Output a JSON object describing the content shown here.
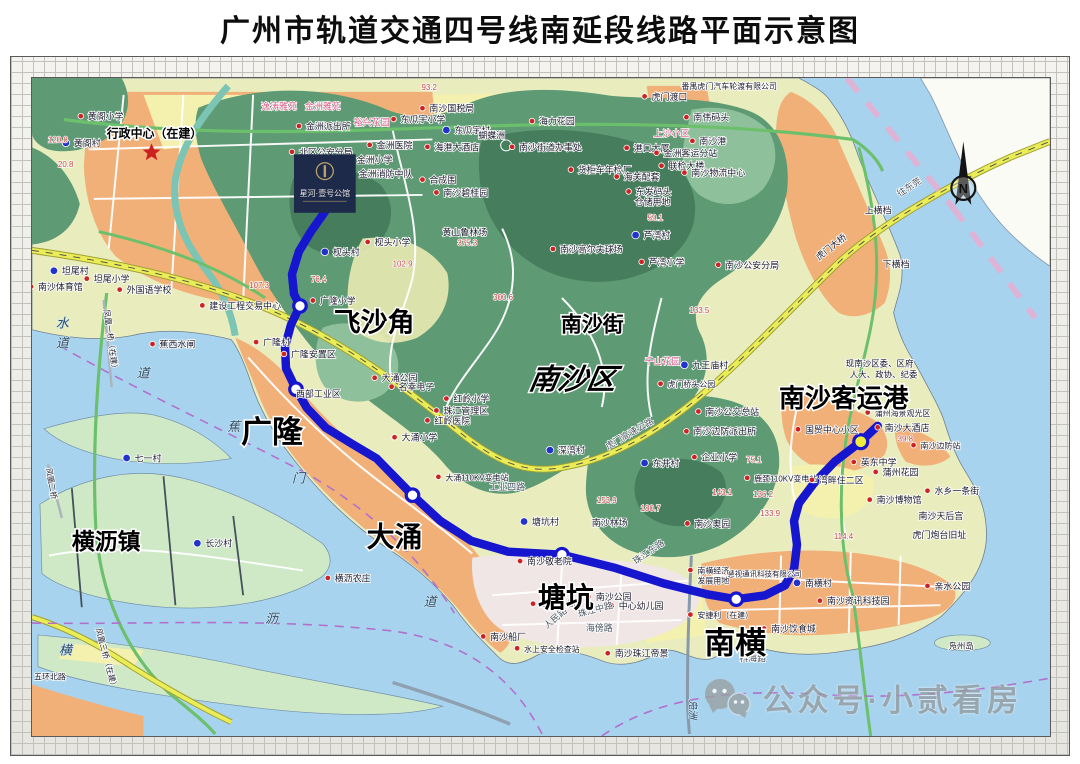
{
  "title": "广州市轨道交通四号线南延段线路平面示意图",
  "watermark": {
    "text": "公众号·小贰看房",
    "icon": "wechat-icon"
  },
  "compass": {
    "label": "N"
  },
  "ad_overlay": {
    "title": "星河·壹号公馆"
  },
  "palette": {
    "metro_line": "#1616cf",
    "station_fill": "#ffffff",
    "terminal_fill": "#f0ec3e",
    "red_dot": "#cc2424",
    "blue_dot": "#2233cc",
    "spot_text": "#c04848",
    "star": "#cc1f1f"
  },
  "map": {
    "line": {
      "name": "四号线南延段",
      "color": "#1616cf",
      "points": [
        [
          322,
          213
        ],
        [
          308,
          233
        ],
        [
          296,
          253
        ],
        [
          289,
          276
        ],
        [
          291,
          296
        ],
        [
          297,
          308
        ],
        [
          288,
          327
        ],
        [
          282,
          349
        ],
        [
          283,
          371
        ],
        [
          293,
          392
        ],
        [
          304,
          411
        ],
        [
          323,
          431
        ],
        [
          349,
          447
        ],
        [
          374,
          462
        ],
        [
          410,
          499
        ],
        [
          438,
          525
        ],
        [
          469,
          545
        ],
        [
          506,
          556
        ],
        [
          560,
          559
        ],
        [
          612,
          572
        ],
        [
          662,
          588
        ],
        [
          706,
          599
        ],
        [
          735,
          604
        ],
        [
          764,
          600
        ],
        [
          784,
          590
        ],
        [
          793,
          574
        ],
        [
          796,
          549
        ],
        [
          793,
          525
        ],
        [
          798,
          507
        ],
        [
          813,
          487
        ],
        [
          834,
          465
        ],
        [
          860,
          445
        ],
        [
          877,
          429
        ]
      ]
    },
    "stations": [
      {
        "name": "飞沙角",
        "x": 297,
        "y": 308,
        "lx": 331,
        "ly": 334,
        "fs": 27
      },
      {
        "name": "广隆",
        "x": 293,
        "y": 392,
        "lx": 238,
        "ly": 446,
        "fs": 31
      },
      {
        "name": "大涌",
        "x": 410,
        "y": 499,
        "lx": 364,
        "ly": 551,
        "fs": 28
      },
      {
        "name": "塘坑",
        "x": 560,
        "y": 559,
        "lx": 536,
        "ly": 612,
        "fs": 28
      },
      {
        "name": "南横",
        "x": 735,
        "y": 604,
        "lx": 703,
        "ly": 659,
        "fs": 31
      },
      {
        "name": "南沙客运港",
        "x": 860,
        "y": 445,
        "lx": 778,
        "ly": 410,
        "fs": 26,
        "terminal": true
      }
    ],
    "area_labels": [
      {
        "t": "行政中心（在建）",
        "x": 103,
        "y": 138,
        "fs": 12
      },
      {
        "t": "南沙街",
        "x": 559,
        "y": 334,
        "fs": 21
      },
      {
        "t": "南沙区",
        "x": 526,
        "y": 392,
        "fs": 29,
        "italic": true
      },
      {
        "t": "横沥镇",
        "x": 68,
        "y": 554,
        "fs": 23
      }
    ],
    "pois": [
      {
        "t": "黄阁小学",
        "x": 84,
        "y": 120,
        "k": "r"
      },
      {
        "t": "黄阁村",
        "x": 70,
        "y": 147,
        "k": "b"
      },
      {
        "t": "120.8",
        "x": 44,
        "y": 143,
        "k": "s"
      },
      {
        "t": "20.8",
        "x": 54,
        "y": 168,
        "k": "s"
      },
      {
        "t": "93.2",
        "x": 419,
        "y": 90,
        "k": "s"
      },
      {
        "t": "南沙国税局",
        "x": 427,
        "y": 112,
        "k": "r"
      },
      {
        "t": "东瓜宇小学",
        "x": 398,
        "y": 123,
        "k": "r"
      },
      {
        "t": "东瓜宇村",
        "x": 452,
        "y": 134,
        "k": "b"
      },
      {
        "t": "海港大酒店",
        "x": 432,
        "y": 151,
        "k": "r"
      },
      {
        "t": "蝴蝶洲",
        "x": 476,
        "y": 139,
        "k": "n"
      },
      {
        "t": "海力花园",
        "x": 537,
        "y": 125,
        "k": "r"
      },
      {
        "t": "南沙街道办事处",
        "x": 517,
        "y": 151,
        "k": "r"
      },
      {
        "t": "货柜车年检厂",
        "x": 576,
        "y": 174,
        "k": "r"
      },
      {
        "t": "港口大厦",
        "x": 632,
        "y": 152,
        "k": "r"
      },
      {
        "t": "海关配套",
        "x": 622,
        "y": 181,
        "k": "r"
      },
      {
        "t": "金洲客运分站",
        "x": 662,
        "y": 157,
        "k": "r"
      },
      {
        "t": "联检大楼",
        "x": 667,
        "y": 170,
        "k": "r"
      },
      {
        "t": "南沙物流中心",
        "x": 690,
        "y": 177,
        "k": "r"
      },
      {
        "t": "东发码头",
        "x": 634,
        "y": 196,
        "k": "r"
      },
      {
        "t": "仓储用地",
        "x": 633,
        "y": 206,
        "k": "n"
      },
      {
        "t": "虎门渡口",
        "x": 650,
        "y": 100,
        "k": "r"
      },
      {
        "t": "番禺虎门汽车轮渡有限公司",
        "x": 680,
        "y": 89,
        "k": "n",
        "fs": 8
      },
      {
        "t": "上沙小区",
        "x": 652,
        "y": 137,
        "k": "p"
      },
      {
        "t": "南伟码头",
        "x": 692,
        "y": 121,
        "k": "r"
      },
      {
        "t": "南沙港",
        "x": 698,
        "y": 145,
        "k": "r"
      },
      {
        "t": "逸涛雅苑",
        "x": 258,
        "y": 110,
        "k": "p"
      },
      {
        "t": "金洲雅苑",
        "x": 302,
        "y": 110,
        "k": "p"
      },
      {
        "t": "裕兴花园",
        "x": 351,
        "y": 126,
        "k": "p"
      },
      {
        "t": "金洲派出所",
        "x": 303,
        "y": 130,
        "k": "r"
      },
      {
        "t": "金洲医院",
        "x": 374,
        "y": 149,
        "k": "r"
      },
      {
        "t": "金洲小学",
        "x": 354,
        "y": 164,
        "k": "r"
      },
      {
        "t": "金洲消防中队",
        "x": 356,
        "y": 178,
        "k": "r"
      },
      {
        "t": "北区公安分局",
        "x": 296,
        "y": 156,
        "k": "r"
      },
      {
        "t": "合成围",
        "x": 427,
        "y": 184,
        "k": "r"
      },
      {
        "t": "南沙碧桂园",
        "x": 441,
        "y": 197,
        "k": "r"
      },
      {
        "t": "枧头村",
        "x": 330,
        "y": 257,
        "k": "b"
      },
      {
        "t": "枧头小学",
        "x": 372,
        "y": 247,
        "k": "r"
      },
      {
        "t": "76.4",
        "x": 308,
        "y": 284,
        "k": "s"
      },
      {
        "t": "107.3",
        "x": 246,
        "y": 290,
        "k": "s"
      },
      {
        "t": "102.9",
        "x": 390,
        "y": 268,
        "k": "s"
      },
      {
        "t": "广隆小学",
        "x": 317,
        "y": 306,
        "k": "r"
      },
      {
        "t": "黄山鲁林场",
        "x": 440,
        "y": 237,
        "k": "n"
      },
      {
        "t": "375.3",
        "x": 455,
        "y": 247,
        "k": "s"
      },
      {
        "t": "300.6",
        "x": 491,
        "y": 302,
        "k": "s"
      },
      {
        "t": "南沙高尔夫球场",
        "x": 558,
        "y": 254,
        "k": "r"
      },
      {
        "t": "芦湾村",
        "x": 642,
        "y": 240,
        "k": "b"
      },
      {
        "t": "芦湾小学",
        "x": 647,
        "y": 267,
        "k": "r"
      },
      {
        "t": "南沙公安分局",
        "x": 724,
        "y": 270,
        "k": "r"
      },
      {
        "t": "59.1",
        "x": 646,
        "y": 222,
        "k": "s"
      },
      {
        "t": "133.5",
        "x": 688,
        "y": 315,
        "k": "s"
      },
      {
        "t": "千山花园",
        "x": 643,
        "y": 367,
        "k": "p"
      },
      {
        "t": "九王庙村",
        "x": 691,
        "y": 371,
        "k": "b"
      },
      {
        "t": "虎门桥头公园",
        "x": 666,
        "y": 390,
        "k": "r",
        "fs": 8
      },
      {
        "t": "南沙公交总站",
        "x": 704,
        "y": 418,
        "k": "r"
      },
      {
        "t": "南沙边防派出所",
        "x": 692,
        "y": 438,
        "k": "r"
      },
      {
        "t": "企业小学",
        "x": 700,
        "y": 464,
        "k": "r"
      },
      {
        "t": "东井村",
        "x": 651,
        "y": 470,
        "k": "b"
      },
      {
        "t": "深湾村",
        "x": 556,
        "y": 457,
        "k": "b"
      },
      {
        "t": "75.1",
        "x": 745,
        "y": 466,
        "k": "s"
      },
      {
        "t": "143.1",
        "x": 711,
        "y": 499,
        "k": "s"
      },
      {
        "t": "136.2",
        "x": 752,
        "y": 501,
        "k": "s"
      },
      {
        "t": "133.9",
        "x": 759,
        "y": 520,
        "k": "s"
      },
      {
        "t": "180.7",
        "x": 639,
        "y": 515,
        "k": "s"
      },
      {
        "t": "153.9",
        "x": 595,
        "y": 507,
        "k": "s"
      },
      {
        "t": "114.4",
        "x": 833,
        "y": 543,
        "k": "s"
      },
      {
        "t": "塘坑村",
        "x": 530,
        "y": 529,
        "k": "b"
      },
      {
        "t": "南沙林场",
        "x": 590,
        "y": 530,
        "k": "n"
      },
      {
        "t": "南沙奥园",
        "x": 693,
        "y": 531,
        "k": "r"
      },
      {
        "t": "鹿颈110KV变电站",
        "x": 753,
        "y": 485,
        "k": "r",
        "fs": 8
      },
      {
        "t": "大涌110KV变电站",
        "x": 443,
        "y": 484,
        "k": "r",
        "fs": 8
      },
      {
        "t": "工业四路",
        "x": 487,
        "y": 494,
        "k": "w"
      },
      {
        "t": "大涌公园",
        "x": 379,
        "y": 384,
        "k": "r"
      },
      {
        "t": "名幸电子",
        "x": 396,
        "y": 393,
        "k": "r"
      },
      {
        "t": "红岭小学",
        "x": 451,
        "y": 405,
        "k": "r"
      },
      {
        "t": "珠江管理区",
        "x": 441,
        "y": 417,
        "k": "r"
      },
      {
        "t": "红岭医院",
        "x": 432,
        "y": 427,
        "k": "r"
      },
      {
        "t": "大涌小学",
        "x": 399,
        "y": 444,
        "k": "r"
      },
      {
        "t": "广隆村",
        "x": 260,
        "y": 348,
        "k": "r"
      },
      {
        "t": "广隆安置区",
        "x": 288,
        "y": 360,
        "k": "r"
      },
      {
        "t": "西部工业区",
        "x": 293,
        "y": 400,
        "k": "n"
      },
      {
        "t": "蕉西水闸",
        "x": 156,
        "y": 350,
        "k": "r"
      },
      {
        "t": "建设工程交易中心",
        "x": 206,
        "y": 311,
        "k": "r"
      },
      {
        "t": "外国语学校",
        "x": 123,
        "y": 295,
        "k": "r"
      },
      {
        "t": "坦尾小学",
        "x": 90,
        "y": 284,
        "k": "r"
      },
      {
        "t": "坦尾村",
        "x": 58,
        "y": 276,
        "k": "b"
      },
      {
        "t": "南沙体育馆",
        "x": 34,
        "y": 292,
        "k": "r"
      },
      {
        "t": "七一村",
        "x": 131,
        "y": 465,
        "k": "b"
      },
      {
        "t": "长沙村",
        "x": 202,
        "y": 551,
        "k": "b"
      },
      {
        "t": "横沥农庄",
        "x": 332,
        "y": 586,
        "k": "r"
      },
      {
        "t": "南沙敬老院",
        "x": 525,
        "y": 569,
        "k": "r"
      },
      {
        "t": "南沙公园",
        "x": 594,
        "y": 605,
        "k": "r"
      },
      {
        "t": "中心幼儿园",
        "x": 617,
        "y": 614,
        "k": "r"
      },
      {
        "t": "邮电分局",
        "x": 538,
        "y": 612,
        "k": "r"
      },
      {
        "t": "珠江中路",
        "x": 577,
        "y": 622,
        "k": "w",
        "rot": -15
      },
      {
        "t": "人民路",
        "x": 545,
        "y": 634,
        "k": "w",
        "rot": -40
      },
      {
        "t": "海傍路",
        "x": 584,
        "y": 636,
        "k": "w"
      },
      {
        "t": "南沙船厂",
        "x": 488,
        "y": 645,
        "k": "r"
      },
      {
        "t": "水上安全检查站",
        "x": 522,
        "y": 657,
        "k": "r",
        "fs": 8
      },
      {
        "t": "南沙珠江帝景",
        "x": 613,
        "y": 662,
        "k": "r"
      },
      {
        "t": "科海路",
        "x": 738,
        "y": 667,
        "k": "w"
      },
      {
        "t": "南沙饮食城",
        "x": 770,
        "y": 637,
        "k": "r"
      },
      {
        "t": "安捷利（在建）",
        "x": 696,
        "y": 623,
        "k": "r",
        "fs": 8
      },
      {
        "t": "南沙资讯科技园",
        "x": 826,
        "y": 609,
        "k": "r"
      },
      {
        "t": "南横村",
        "x": 804,
        "y": 591,
        "k": "b"
      },
      {
        "t": "慧视通讯科技有限公司",
        "x": 726,
        "y": 581,
        "k": "n",
        "fs": 7.5
      },
      {
        "t": "南横经济",
        "x": 696,
        "y": 578,
        "k": "r",
        "fs": 8
      },
      {
        "t": "发展用地",
        "x": 696,
        "y": 588,
        "k": "n",
        "fs": 8
      },
      {
        "t": "珠江东路",
        "x": 634,
        "y": 569,
        "k": "w",
        "rot": -35
      },
      {
        "t": "凫洲",
        "x": 688,
        "y": 705,
        "k": "v",
        "rot": 90,
        "fs": 10
      },
      {
        "t": "凫州岛",
        "x": 948,
        "y": 654,
        "k": "n",
        "fs": 8.5
      },
      {
        "t": "亲水公园",
        "x": 934,
        "y": 594,
        "k": "r"
      },
      {
        "t": "虎门炮台旧址",
        "x": 912,
        "y": 542,
        "k": "n"
      },
      {
        "t": "南沙天后宫",
        "x": 918,
        "y": 523,
        "k": "n"
      },
      {
        "t": "南沙博物馆",
        "x": 876,
        "y": 507,
        "k": "r"
      },
      {
        "t": "水乡一条街",
        "x": 934,
        "y": 498,
        "k": "r"
      },
      {
        "t": "蒲州花园",
        "x": 882,
        "y": 479,
        "k": "r"
      },
      {
        "t": "英东中学",
        "x": 860,
        "y": 469,
        "k": "r"
      },
      {
        "t": "湾畔住二区",
        "x": 818,
        "y": 487,
        "k": "r"
      },
      {
        "t": "国贸中心小区",
        "x": 804,
        "y": 436,
        "k": "r"
      },
      {
        "t": "南沙大酒店",
        "x": 884,
        "y": 434,
        "k": "r"
      },
      {
        "t": "蒲州海景观光区",
        "x": 874,
        "y": 419,
        "k": "r",
        "fs": 8
      },
      {
        "t": "39.8",
        "x": 897,
        "y": 445,
        "k": "s"
      },
      {
        "t": "南沙边防站",
        "x": 920,
        "y": 452,
        "k": "r",
        "fs": 8
      },
      {
        "t": "现南沙区委、区府",
        "x": 845,
        "y": 369,
        "k": "n",
        "fs": 8.5
      },
      {
        "t": "人大、政协、纪委",
        "x": 849,
        "y": 380,
        "k": "n",
        "fs": 8.5
      },
      {
        "t": "上横档",
        "x": 864,
        "y": 215,
        "k": "n"
      },
      {
        "t": "下横档",
        "x": 882,
        "y": 269,
        "k": "n"
      },
      {
        "t": "往东莞",
        "x": 899,
        "y": 198,
        "k": "w",
        "rot": -33
      },
      {
        "t": "虎门大桥",
        "x": 818,
        "y": 262,
        "k": "n",
        "rot": -38
      },
      {
        "t": "虎门高速公路",
        "x": 606,
        "y": 453,
        "k": "w",
        "rot": -30
      },
      {
        "t": "五环北路",
        "x": 30,
        "y": 685,
        "k": "n",
        "fs": 8
      },
      {
        "t": "凤凰三桥（在建）",
        "x": 92,
        "y": 634,
        "k": "n",
        "rot": 75,
        "fs": 8
      },
      {
        "t": "凤凰二桥",
        "x": 42,
        "y": 472,
        "k": "n",
        "rot": 80,
        "fs": 8
      },
      {
        "t": "凤凰一桥（在建）",
        "x": 100,
        "y": 312,
        "k": "n",
        "rot": 82,
        "fs": 8
      },
      {
        "t": "水",
        "x": 52,
        "y": 330,
        "k": "v"
      },
      {
        "t": "道",
        "x": 52,
        "y": 350,
        "k": "v"
      },
      {
        "t": "道",
        "x": 133,
        "y": 380,
        "k": "v"
      },
      {
        "t": "蕉",
        "x": 224,
        "y": 434,
        "k": "v"
      },
      {
        "t": "门",
        "x": 289,
        "y": 486,
        "k": "v"
      },
      {
        "t": "沥",
        "x": 262,
        "y": 628,
        "k": "v"
      },
      {
        "t": "横",
        "x": 55,
        "y": 660,
        "k": "v"
      },
      {
        "t": "道",
        "x": 421,
        "y": 611,
        "k": "v"
      }
    ]
  }
}
